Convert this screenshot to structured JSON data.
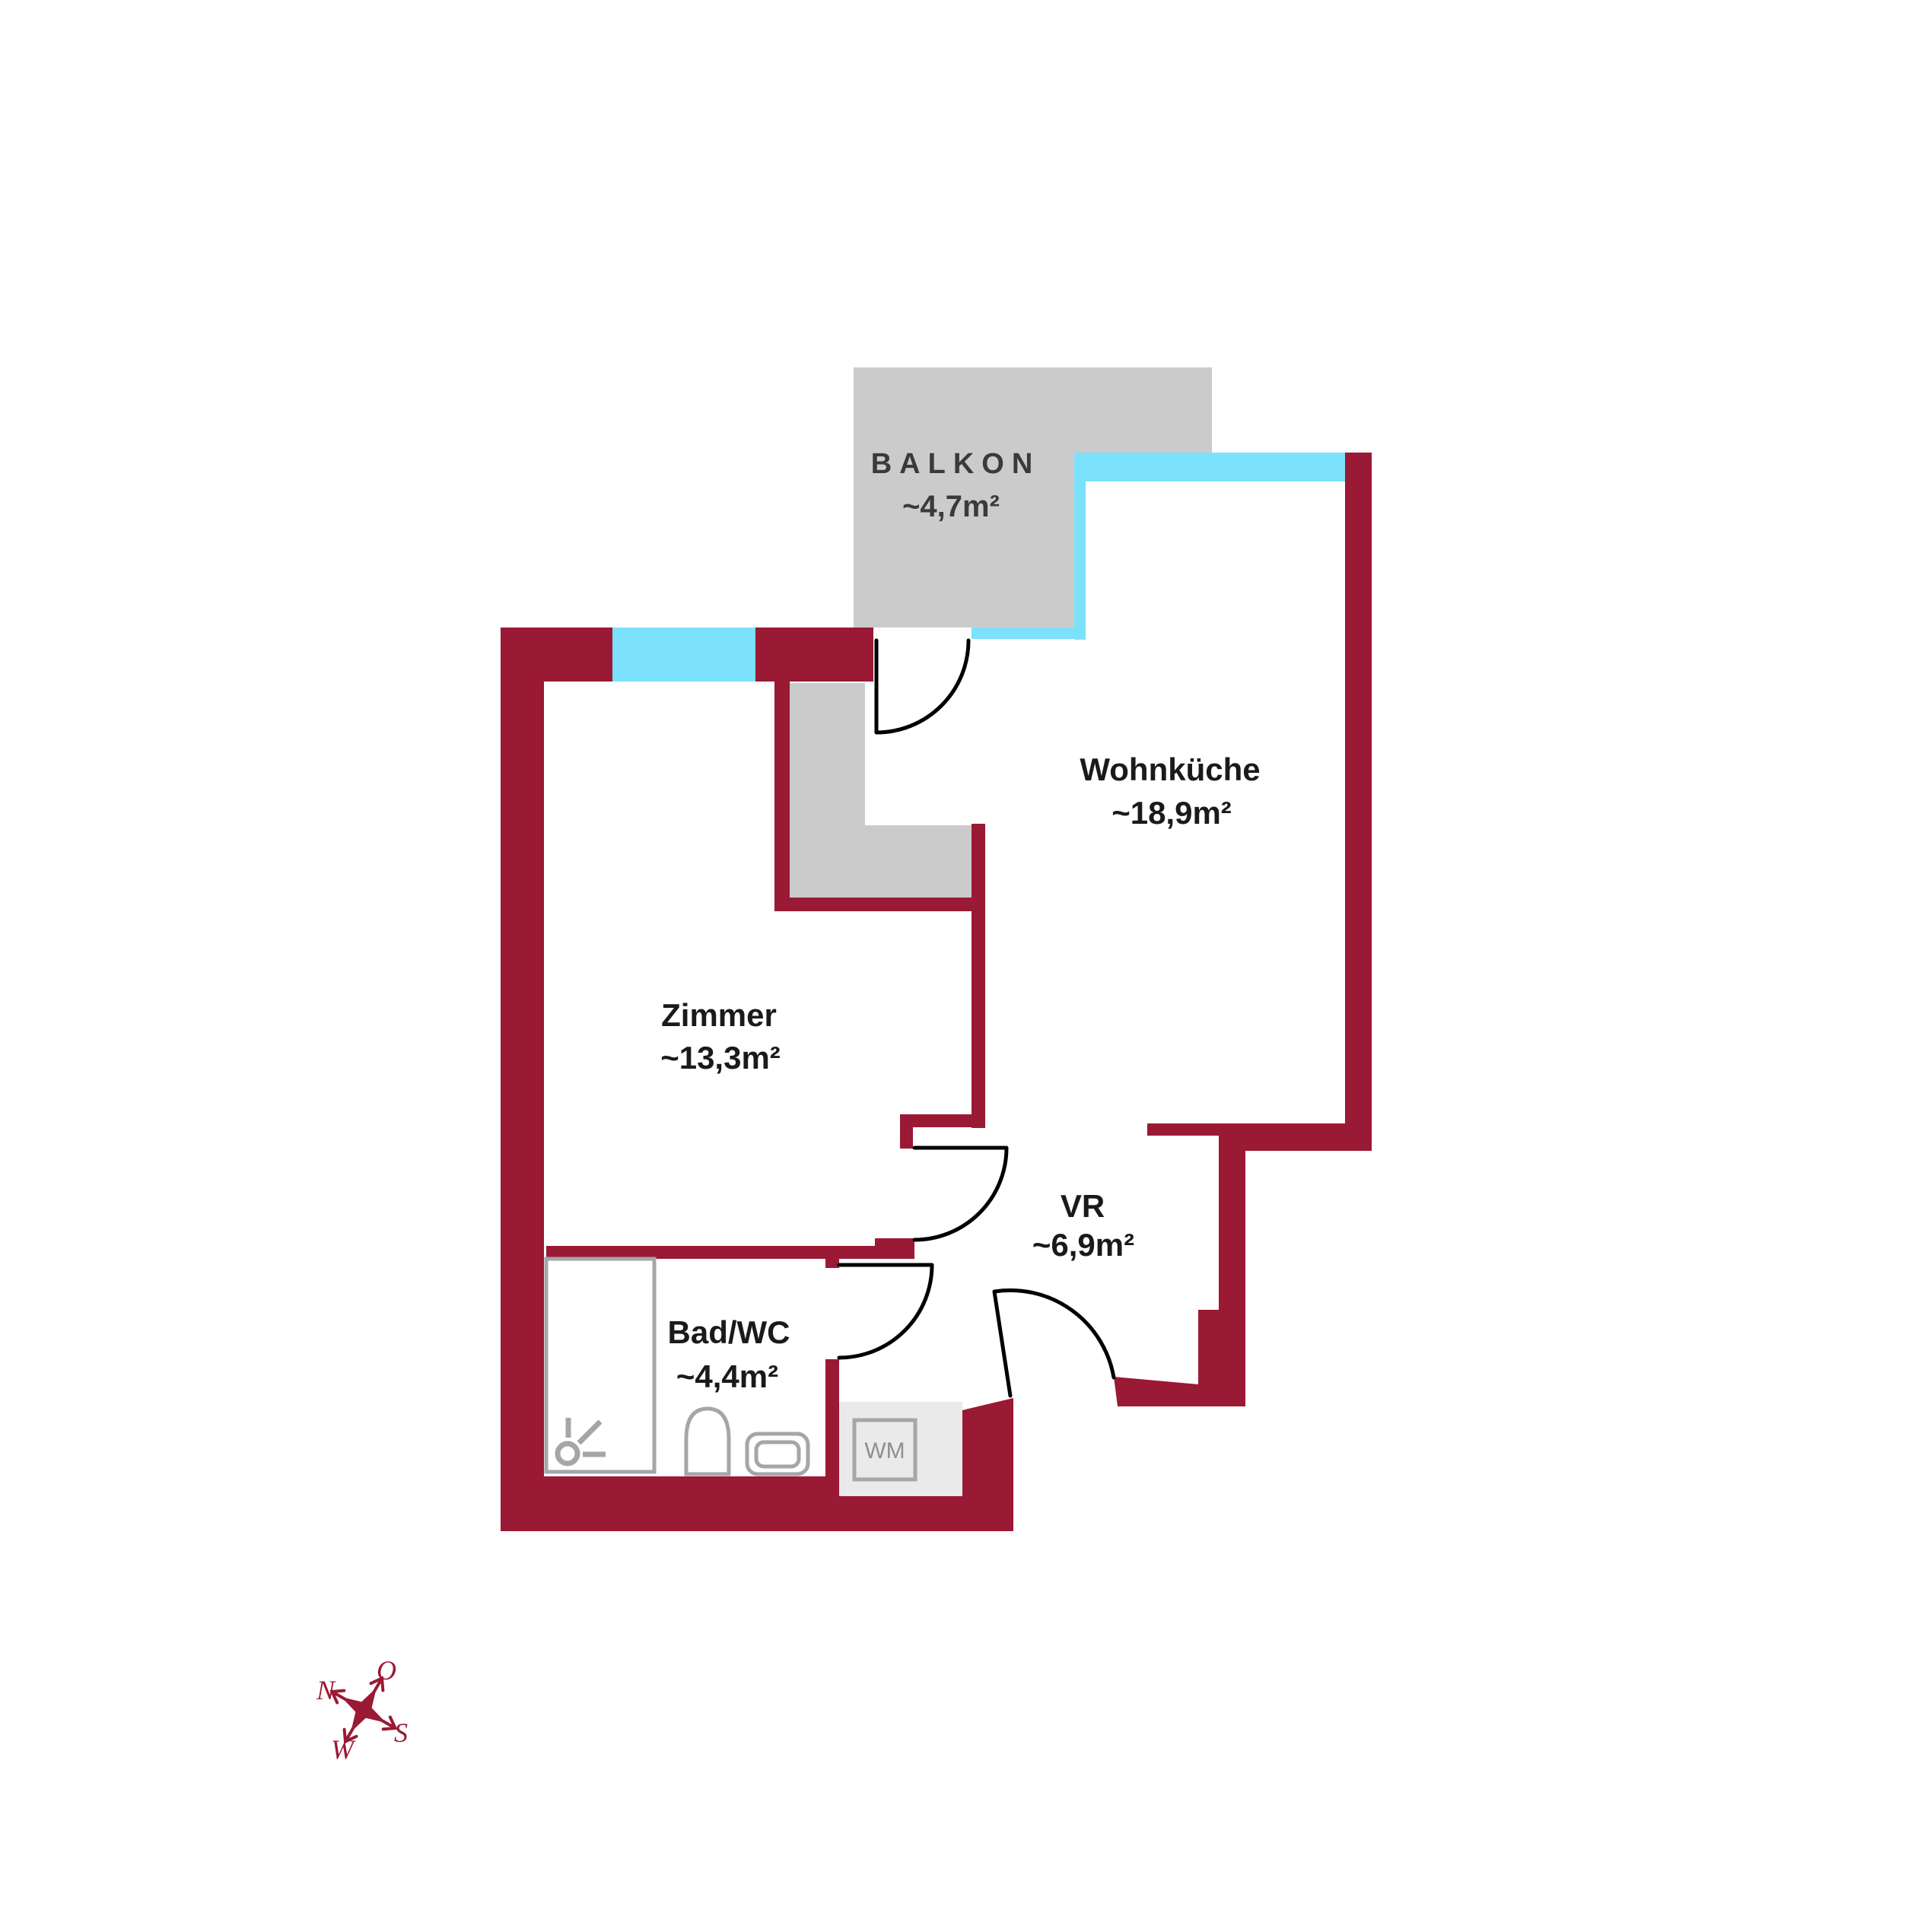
{
  "colors": {
    "wall": "#9A1934",
    "window": "#7CE1FA",
    "slab": "#CCCBCB",
    "kitchen_unit": "#CCCBCB",
    "wm_floor": "#EBEAEA",
    "door": "#000000",
    "fixture": "#A6A6A6",
    "label": "#1A1A1A",
    "balkon_label": "#3A3A3A",
    "wm_label": "#8F8F8F",
    "compass": "#9A1934"
  },
  "rooms": [
    {
      "id": "balkon",
      "name": "BALKON",
      "area": "~4,7m²"
    },
    {
      "id": "wohnkueche",
      "name": "Wohnküche",
      "area": "~18,9m²"
    },
    {
      "id": "zimmer",
      "name": "Zimmer",
      "area": "~13,3m²"
    },
    {
      "id": "vorraum",
      "name": "VR",
      "area": "~6,9m²"
    },
    {
      "id": "bad_wc",
      "name": "Bad/WC",
      "area": "~4,4m²"
    }
  ],
  "appliances": {
    "washing_machine": "WM"
  },
  "compass": {
    "north": "N",
    "east": "O",
    "south": "S",
    "west": "W"
  }
}
